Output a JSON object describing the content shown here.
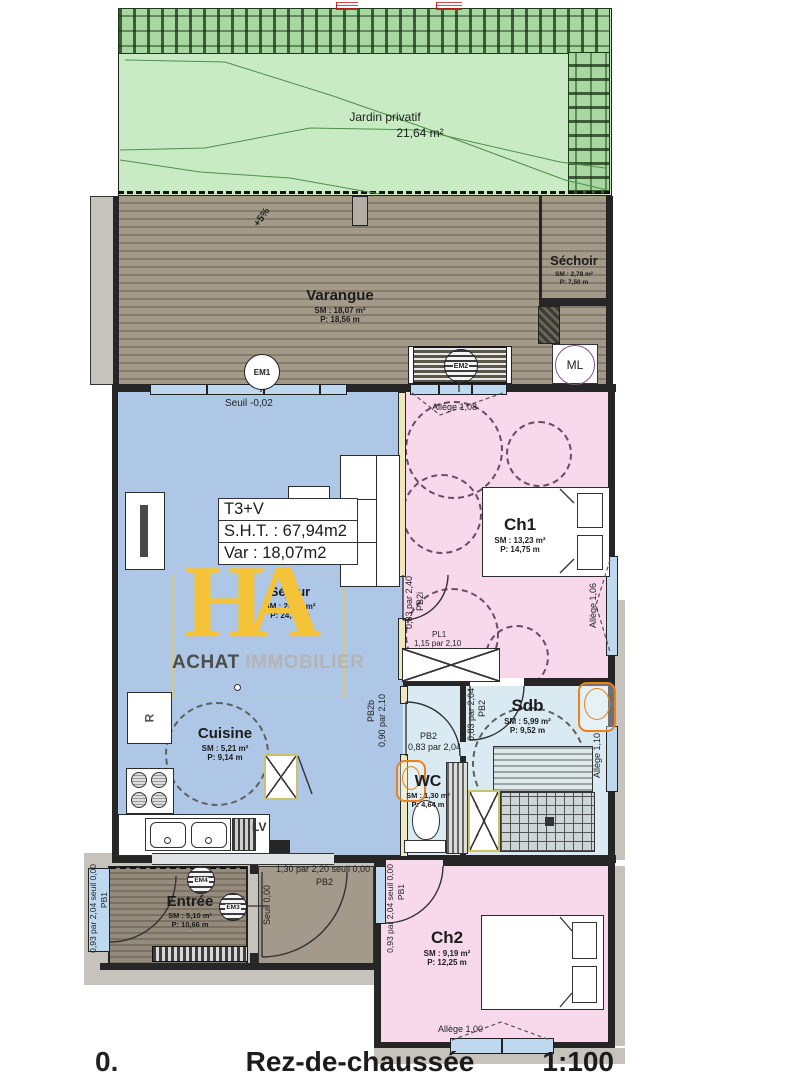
{
  "meta": {
    "floor_index": "0.",
    "floor_name": "Rez-de-chaussée",
    "scale": "1:100"
  },
  "summary": {
    "type": "T3+V",
    "sht": "S.H.T. : 67,94m2",
    "var": "Var : 18,07m2"
  },
  "logo": {
    "h": "H",
    "a": "A",
    "brand1": "ACHAT",
    "brand2": "IMMOBILIER"
  },
  "garden": {
    "name": "Jardin privatif",
    "area": "21,64 m²"
  },
  "rooms": [
    {
      "name": "Varangue",
      "sm": "SM : 18,07 m²",
      "p": "P: 18,56 m"
    },
    {
      "name": "Séchoir",
      "sm": "SM : 2,78 m²",
      "p": "P: 7,50 m"
    },
    {
      "name": "Séjour",
      "sm": "SM : 25,80 m²",
      "p": "P: 24,72 m"
    },
    {
      "name": "Ch1",
      "sm": "SM : 13,23 m²",
      "p": "P: 14,75 m"
    },
    {
      "name": "Cuisine",
      "sm": "SM : 5,21 m²",
      "p": "P: 9,14 m"
    },
    {
      "name": "Sdb",
      "sm": "SM : 5,99 m²",
      "p": "P: 9,52 m"
    },
    {
      "name": "WC",
      "sm": "SM : 1,30 m²",
      "p": "P: 4,64 m"
    },
    {
      "name": "Entrée",
      "sm": "SM : 5,10 m²",
      "p": "P: 10,66 m"
    },
    {
      "name": "Ch2",
      "sm": "SM : 9,19 m²",
      "p": "P: 12,25 m"
    }
  ],
  "annotations": {
    "seuil_sejour": "Seuil -0,02",
    "allege_ch1_top": "Allège 1,08",
    "allege_ch1_right": "Allège 1,06",
    "allege_sdb": "Allège 1,10",
    "allege_ch2": "Allège 1,00",
    "slope": "+5%",
    "door_ch1_dim": "0,83 par 2,40",
    "door_ch1_code": "PB2i",
    "closet_code": "PL1",
    "closet_dim": "1,15 par 2,10",
    "door_sdb_dim": "0,83 par 2,04",
    "door_sdb_code": "PB2",
    "door_wc_code": "PB2",
    "door_wc_dim": "0,83 par 2,04",
    "door_kitchen_code": "PB2b",
    "door_kitchen_dim": "0,90 par 2,10",
    "door_entree_dim": "1,30 par 2,20 seuil 0,00",
    "door_entree_code": "PB2",
    "seuil_entree": "Seuil 0,00",
    "door_porch_dim": "0,93 par 2,04 seuil 0,00",
    "door_porch_code": "PB1",
    "door_ch2_dim": "0,93 par 2,04 seuil 0,00",
    "door_ch2_code": "PB1"
  },
  "equipment": {
    "ml": "ML",
    "em1": "EM1",
    "em2": "EM2",
    "em3": "EM3",
    "em4": "EM4",
    "lv": "LV",
    "fridge": "R"
  },
  "colors": {
    "logo_yellow": "#f5c338",
    "basin_orange": "#e8821e",
    "garden_green": "#c9ebc4",
    "living_blue": "#aec7e6",
    "bedroom_pink": "#f8d9ec",
    "bath_blue": "#d9eaf3",
    "deck_taupe": "#9d9484"
  }
}
